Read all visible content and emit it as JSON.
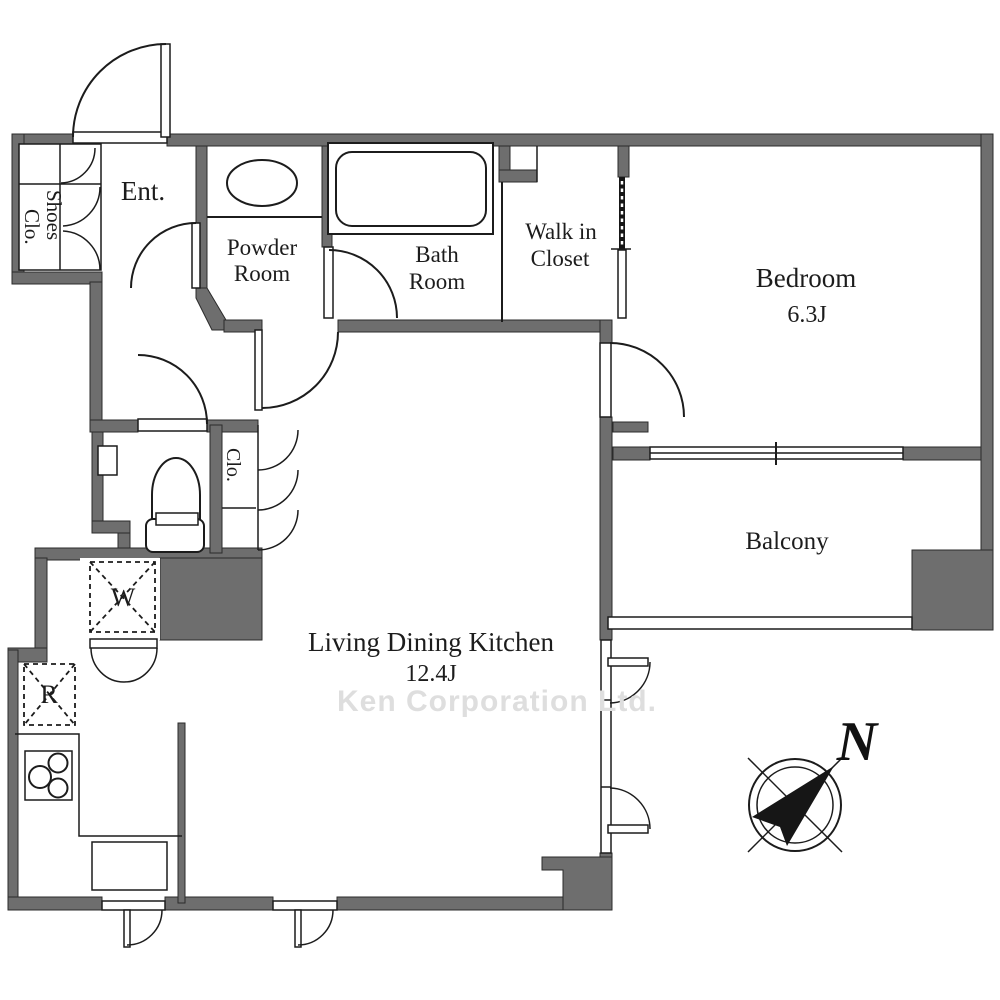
{
  "plan": {
    "rooms": {
      "entrance": {
        "label": "Ent."
      },
      "shoes_closet": {
        "line1": "Shoes",
        "line2": "Clo."
      },
      "powder_room": {
        "line1": "Powder",
        "line2": "Room"
      },
      "bath_room": {
        "line1": "Bath",
        "line2": "Room"
      },
      "walk_in_closet": {
        "line1": "Walk in",
        "line2": "Closet"
      },
      "bedroom": {
        "label": "Bedroom",
        "size": "6.3J"
      },
      "balcony": {
        "label": "Balcony"
      },
      "closet": {
        "label": "Clo."
      },
      "living_dining_kitchen": {
        "label": "Living Dining Kitchen",
        "size": "12.4J"
      }
    },
    "appliances": {
      "washer": "W",
      "refrigerator": "R"
    },
    "compass": {
      "north": "N"
    },
    "watermark": "Ken Corporation Ltd."
  },
  "colors": {
    "wall": "#6e6e6e",
    "line": "#1c1c1c",
    "watermark": "#dedede",
    "background": "#ffffff"
  }
}
